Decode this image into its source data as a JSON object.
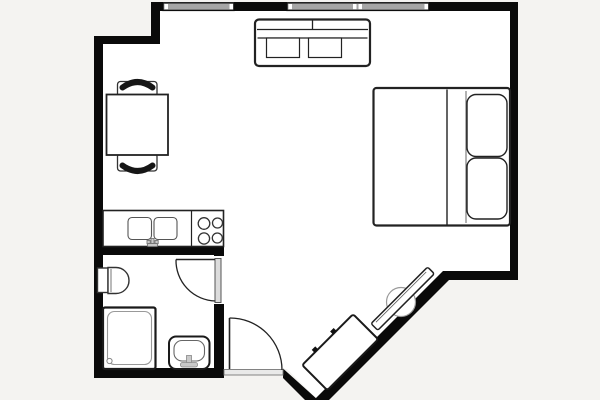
{
  "colors": {
    "outside": "#f4f3f1",
    "floor": "#ffffff",
    "wall": "#0a0a0a",
    "line": "#222222",
    "detail": "#555555",
    "window_fill": "#a6a6a6",
    "fixture_fill": "#c9c9c9",
    "door_leaf_fill": "#dcdcdc",
    "threshold_fill": "#e9e9e9"
  },
  "elements": {
    "furniture": [
      "sofa",
      "double-bed",
      "pillows",
      "dining-table",
      "chairs",
      "dresser",
      "tv-on-diagonal-wall"
    ],
    "kitchen": [
      "kitchen-counter",
      "double-sink",
      "kitchen-faucet",
      "stove-four-burners"
    ],
    "bathroom": [
      "toilet",
      "shower",
      "washbasin"
    ],
    "openings": [
      "window-band-left",
      "window-band-right",
      "bathroom-door",
      "entry-door",
      "entry-threshold"
    ]
  }
}
